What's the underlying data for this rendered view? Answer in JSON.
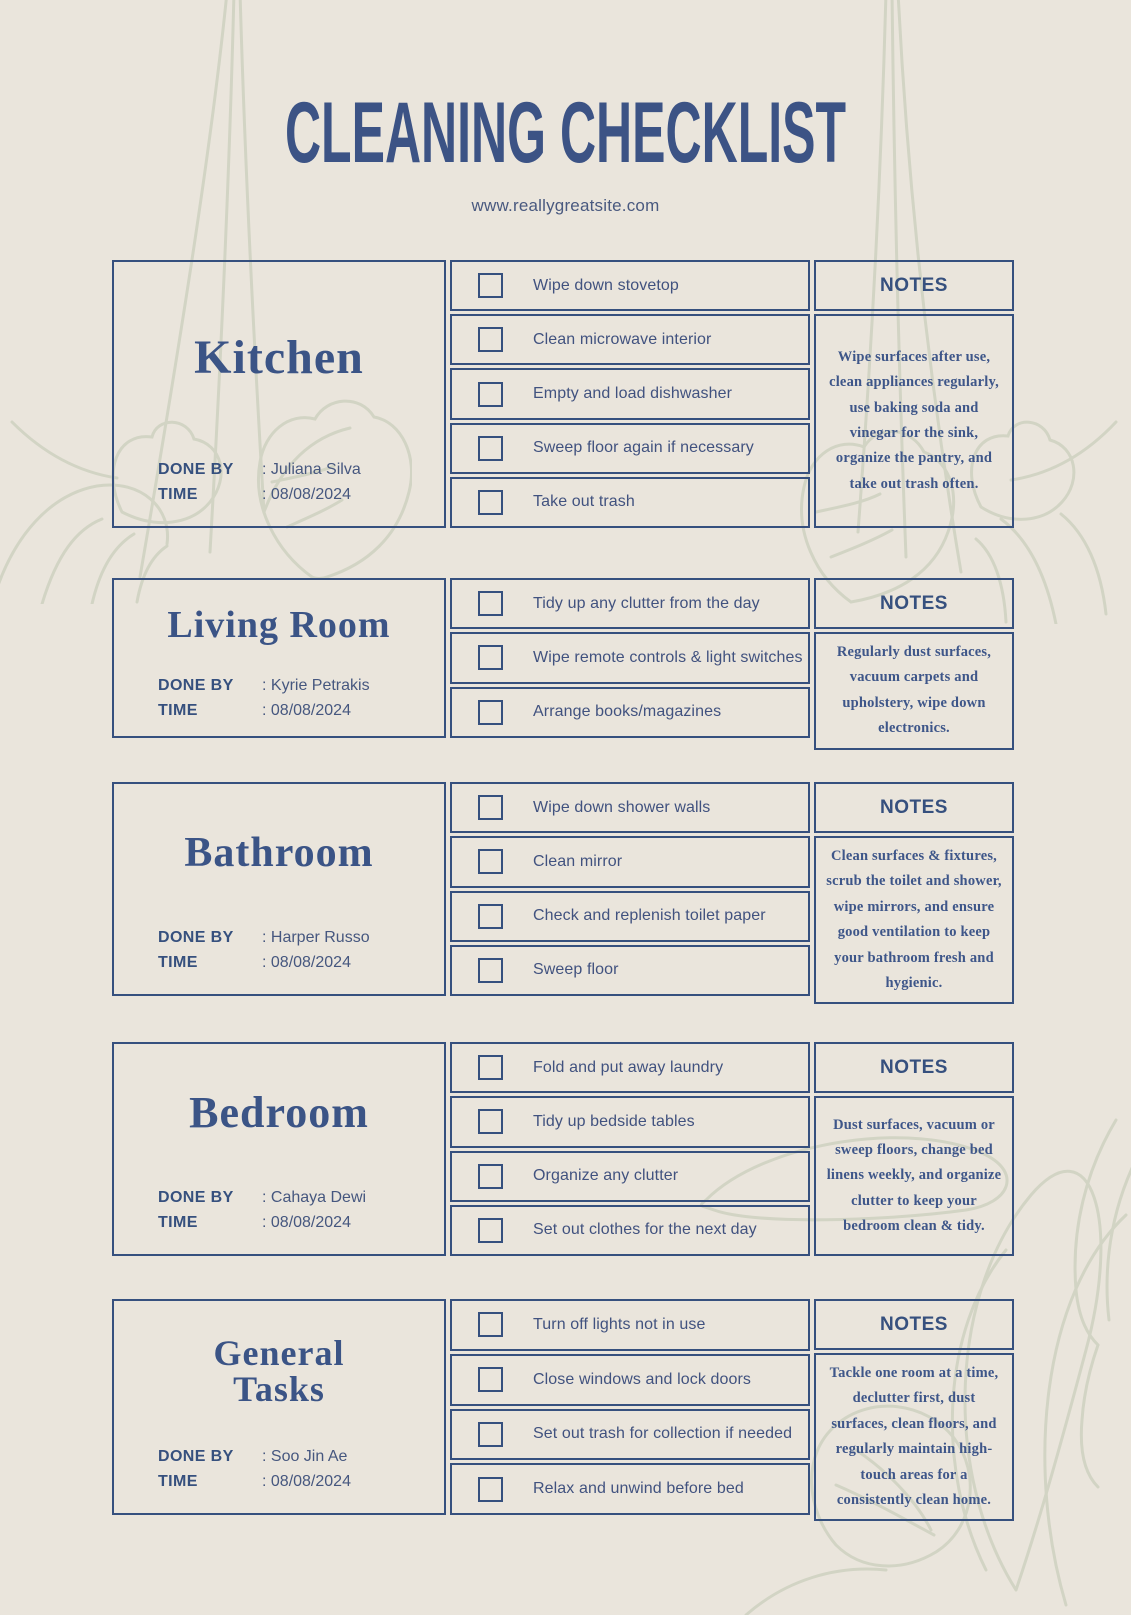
{
  "page": {
    "title": "CLEANING CHECKLIST",
    "website": "www.reallygreatsite.com",
    "notes_header": "NOTES",
    "done_by_label": "DONE BY",
    "time_label": "TIME"
  },
  "colors": {
    "background": "#eae5dc",
    "ink_blue": "#3c5385",
    "border_blue": "#36507e",
    "leaf_sage": "#d2d4c4"
  },
  "sections": [
    {
      "id": "kitchen",
      "title": "Kitchen",
      "done_by": ": Juliana Silva",
      "time": ": 08/08/2024",
      "items": [
        "Wipe down stovetop",
        "Clean microwave interior",
        "Empty and load dishwasher",
        "Sweep floor again if necessary",
        "Take out trash"
      ],
      "notes": "Wipe surfaces after use, clean appliances regularly, use baking soda and vinegar for the sink, organize the pantry, and take out trash often."
    },
    {
      "id": "living-room",
      "title": "Living Room",
      "done_by": ": Kyrie Petrakis",
      "time": ": 08/08/2024",
      "items": [
        "Tidy up any clutter from the day",
        "Wipe remote controls & light switches",
        "Arrange books/magazines"
      ],
      "notes": "Regularly dust surfaces, vacuum carpets and upholstery, wipe down electronics."
    },
    {
      "id": "bathroom",
      "title": "Bathroom",
      "done_by": ": Harper Russo",
      "time": ": 08/08/2024",
      "items": [
        "Wipe down shower walls",
        "Clean mirror",
        "Check and replenish toilet paper",
        "Sweep floor"
      ],
      "notes": "Clean surfaces & fixtures, scrub the toilet and shower, wipe mirrors, and ensure good ventilation to keep your bathroom fresh and hygienic."
    },
    {
      "id": "bedroom",
      "title": "Bedroom",
      "done_by": ": Cahaya Dewi",
      "time": ": 08/08/2024",
      "items": [
        "Fold and put away laundry",
        "Tidy up bedside tables",
        "Organize any clutter",
        "Set out clothes for the next day"
      ],
      "notes": "Dust surfaces, vacuum or sweep floors, change bed linens weekly, and organize clutter to keep your bedroom clean & tidy."
    },
    {
      "id": "general-tasks",
      "title": "General Tasks",
      "done_by": ": Soo Jin Ae",
      "time": ": 08/08/2024",
      "items": [
        "Turn off lights not in use",
        "Close windows and lock doors",
        "Set out trash for collection if needed",
        "Relax and unwind before bed"
      ],
      "notes": "Tackle one room at a time, declutter first, dust surfaces, clean floors, and regularly maintain high-touch areas for a consistently clean home."
    }
  ]
}
